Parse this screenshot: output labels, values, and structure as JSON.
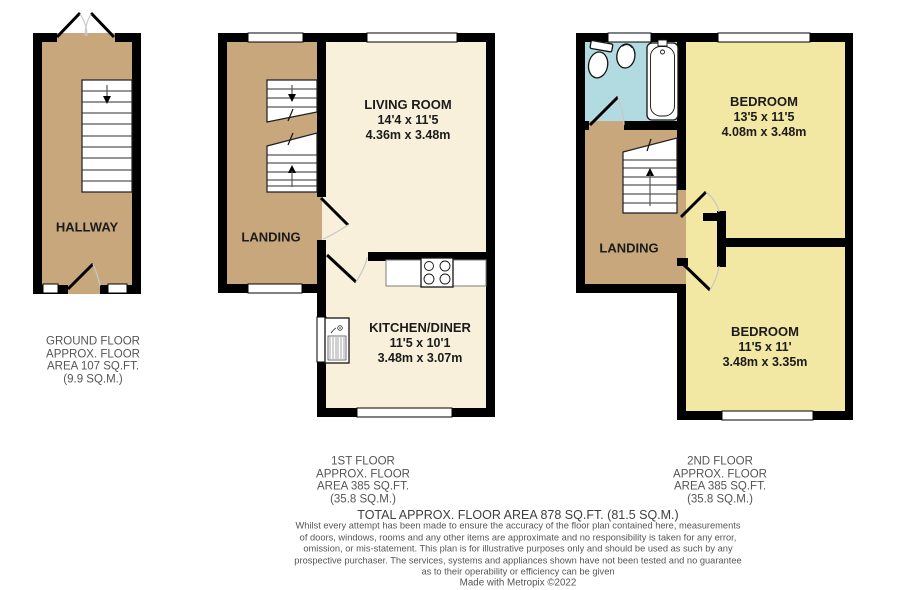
{
  "floors": {
    "ground": {
      "rooms": {
        "hallway": {
          "name": "HALLWAY"
        }
      },
      "summary": [
        "GROUND FLOOR",
        "APPROX. FLOOR",
        "AREA 107 SQ.FT.",
        "(9.9 SQ.M.)"
      ]
    },
    "first": {
      "rooms": {
        "living_room": {
          "name": "LIVING ROOM",
          "dim_imperial": "14'4 x 11'5",
          "dim_metric": "4.36m x 3.48m"
        },
        "landing": {
          "name": "LANDING"
        },
        "kitchen": {
          "name": "KITCHEN/DINER",
          "dim_imperial": "11'5 x 10'1",
          "dim_metric": "3.48m x 3.07m"
        }
      },
      "summary": [
        "1ST FLOOR",
        "APPROX. FLOOR",
        "AREA 385 SQ.FT.",
        "(35.8 SQ.M.)"
      ]
    },
    "second": {
      "rooms": {
        "bedroom_front": {
          "name": "BEDROOM",
          "dim_imperial": "13'5 x 11'5",
          "dim_metric": "4.08m x 3.48m"
        },
        "landing": {
          "name": "LANDING"
        },
        "bedroom_back": {
          "name": "BEDROOM",
          "dim_imperial": "11'5 x 11'",
          "dim_metric": "3.48m x 3.35m"
        }
      },
      "summary": [
        "2ND FLOOR",
        "APPROX. FLOOR",
        "AREA 385 SQ.FT.",
        "(35.8 SQ.M.)"
      ]
    }
  },
  "footer": {
    "total": "TOTAL APPROX. FLOOR AREA 878 SQ.FT. (81.5 SQ.M.)",
    "disclaimer": [
      "Whilst every attempt has been made to ensure the accuracy of the floor plan contained here, measurements",
      "of doors, windows, rooms and any other items are approximate and no responsibility is taken for any error,",
      "omission, or mis-statement. This plan is for illustrative purposes only and should be used as such by any",
      "prospective purchaser. The services, systems and appliances shown have not been tested and no guarantee",
      "as to their operability or efficiency can be given"
    ],
    "credit": "Made with Metropix ©2022"
  },
  "colors": {
    "landing": "#C8A77D",
    "living": "#F8F0DB",
    "bedroom": "#F2E7A3",
    "bathroom": "#B2DBE1",
    "wall": "#000000",
    "arc": "#C8C8C8"
  }
}
